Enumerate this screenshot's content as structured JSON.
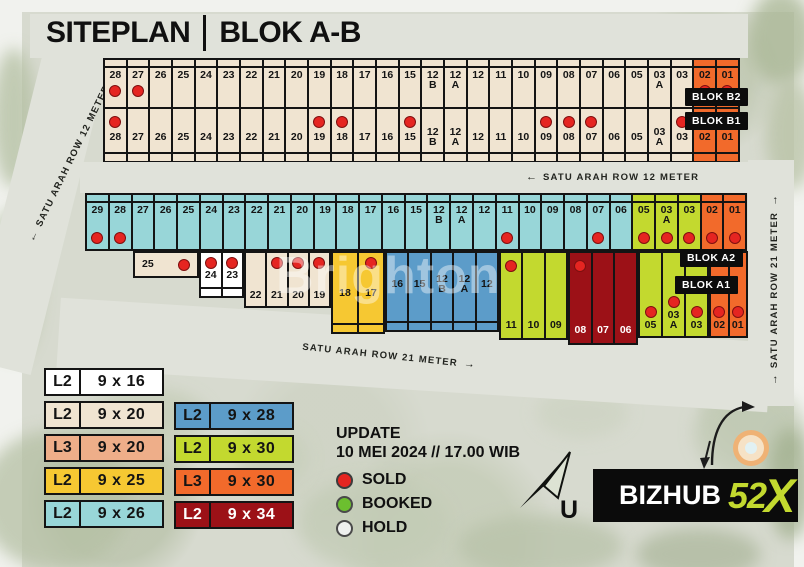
{
  "title": {
    "left": "SITEPLAN",
    "right": "BLOK A-B"
  },
  "watermark": "Brighton",
  "roads": {
    "left": {
      "arrow": "←",
      "text": "SATU ARAH ROW 12 METER"
    },
    "middle": {
      "arrow": "←",
      "text": "SATU ARAH ROW 12 METER"
    },
    "bottom": {
      "text": "SATU ARAH ROW 21 METER",
      "arrow": "→"
    },
    "right": {
      "arrow_start": "→",
      "text": "SATU ARAH ROW 21 METER",
      "arrow_end": "→"
    }
  },
  "colors": {
    "white": "#ffffff",
    "beige": "#f0e4d1",
    "salmon": "#eeae89",
    "yellow": "#f6c832",
    "cyan": "#98d6d8",
    "blue": "#5c9cc9",
    "green": "#c3d92f",
    "orange": "#f26a2b",
    "darkred": "#9c1117",
    "dot_sold": "#e52521",
    "booked": "#6cbf2f",
    "hold": "#eef0ee"
  },
  "blocks": {
    "b2": {
      "label": "BLOK B2",
      "color": "beige",
      "cells": [
        {
          "n": "28",
          "d": 1
        },
        {
          "n": "27",
          "d": 1
        },
        {
          "n": "26"
        },
        {
          "n": "25"
        },
        {
          "n": "24"
        },
        {
          "n": "23"
        },
        {
          "n": "22"
        },
        {
          "n": "21"
        },
        {
          "n": "20"
        },
        {
          "n": "19"
        },
        {
          "n": "18"
        },
        {
          "n": "17"
        },
        {
          "n": "16"
        },
        {
          "n": "15"
        },
        {
          "n": "12\nB"
        },
        {
          "n": "12\nA"
        },
        {
          "n": "12"
        },
        {
          "n": "11"
        },
        {
          "n": "10"
        },
        {
          "n": "09"
        },
        {
          "n": "08"
        },
        {
          "n": "07"
        },
        {
          "n": "06"
        },
        {
          "n": "05"
        },
        {
          "n": "03\nA"
        },
        {
          "n": "03"
        },
        {
          "n": "02",
          "c": "orange",
          "d": 1
        },
        {
          "n": "01",
          "c": "orange",
          "d": 1
        }
      ]
    },
    "b1": {
      "label": "BLOK B1",
      "color": "beige",
      "cells": [
        {
          "n": "28",
          "d": 1
        },
        {
          "n": "27"
        },
        {
          "n": "26"
        },
        {
          "n": "25"
        },
        {
          "n": "24"
        },
        {
          "n": "23"
        },
        {
          "n": "22"
        },
        {
          "n": "21"
        },
        {
          "n": "20"
        },
        {
          "n": "19",
          "d": 1
        },
        {
          "n": "18",
          "d": 1
        },
        {
          "n": "17"
        },
        {
          "n": "16"
        },
        {
          "n": "15",
          "d": 1
        },
        {
          "n": "12\nB"
        },
        {
          "n": "12\nA"
        },
        {
          "n": "12"
        },
        {
          "n": "11"
        },
        {
          "n": "10"
        },
        {
          "n": "09",
          "d": 1
        },
        {
          "n": "08",
          "d": 1
        },
        {
          "n": "07",
          "d": 1
        },
        {
          "n": "06"
        },
        {
          "n": "05"
        },
        {
          "n": "03\nA"
        },
        {
          "n": "03",
          "d": 1
        },
        {
          "n": "02",
          "c": "orange",
          "d": 1
        },
        {
          "n": "01",
          "c": "orange",
          "d": 1
        }
      ]
    },
    "a2": {
      "label": "BLOK A2",
      "color": "cyan",
      "cells": [
        {
          "n": "29",
          "d": 1
        },
        {
          "n": "28",
          "d": 1
        },
        {
          "n": "27"
        },
        {
          "n": "26"
        },
        {
          "n": "25"
        },
        {
          "n": "24"
        },
        {
          "n": "23"
        },
        {
          "n": "22"
        },
        {
          "n": "21"
        },
        {
          "n": "20"
        },
        {
          "n": "19"
        },
        {
          "n": "18"
        },
        {
          "n": "17"
        },
        {
          "n": "16"
        },
        {
          "n": "15"
        },
        {
          "n": "12\nB"
        },
        {
          "n": "12\nA"
        },
        {
          "n": "12"
        },
        {
          "n": "11",
          "d": 1
        },
        {
          "n": "10"
        },
        {
          "n": "09"
        },
        {
          "n": "08"
        },
        {
          "n": "07",
          "d": 1
        },
        {
          "n": "06"
        },
        {
          "n": "05",
          "c": "green",
          "d": 1
        },
        {
          "n": "03\nA",
          "c": "green",
          "d": 1
        },
        {
          "n": "03",
          "c": "green",
          "d": 1
        },
        {
          "n": "02",
          "c": "orange",
          "d": 1
        },
        {
          "n": "01",
          "c": "orange",
          "d": 1
        }
      ]
    },
    "a1": {
      "label": "BLOK A1",
      "groups": [
        {
          "mode": "wide",
          "color": "beige",
          "cells": [
            {
              "n": "25",
              "d": 1
            }
          ]
        },
        {
          "mode": "white",
          "color": "white",
          "cells": [
            {
              "n": "24",
              "d": 1
            },
            {
              "n": "23",
              "d": 1
            }
          ]
        },
        {
          "mode": "mid",
          "color": "beige",
          "cells": [
            {
              "n": "22"
            },
            {
              "n": "21",
              "d": 1
            },
            {
              "n": "20",
              "d": 1
            },
            {
              "n": "19",
              "d": 1
            }
          ]
        },
        {
          "mode": "tallstrip",
          "color": "yellow",
          "cells": [
            {
              "n": "18"
            },
            {
              "n": "17",
              "d": 1
            }
          ]
        },
        {
          "mode": "numstrip",
          "color": "blue",
          "cells": [
            {
              "n": "16"
            },
            {
              "n": "15"
            },
            {
              "n": "12\nB"
            },
            {
              "n": "12\nA"
            },
            {
              "n": "12"
            }
          ]
        },
        {
          "mode": "topdot",
          "color": "green",
          "cells": [
            {
              "n": "11",
              "d": 1
            },
            {
              "n": "10"
            },
            {
              "n": "09"
            }
          ]
        },
        {
          "mode": "topdot",
          "color": "darkred",
          "light": true,
          "cells": [
            {
              "n": "08",
              "d": 1
            },
            {
              "n": "07"
            },
            {
              "n": "06"
            }
          ]
        },
        {
          "mode": "low",
          "color": "green",
          "cells": [
            {
              "n": "05",
              "d": 1
            },
            {
              "n": "03\nA",
              "d": 1
            },
            {
              "n": "03",
              "d": 1
            }
          ]
        },
        {
          "mode": "low",
          "color": "orange",
          "cells": [
            {
              "n": "02",
              "d": 1
            },
            {
              "n": "01",
              "d": 1
            }
          ]
        }
      ]
    }
  },
  "size_legend": {
    "col1": [
      {
        "type": "L2",
        "size": "9 x 16",
        "color": "white"
      },
      {
        "type": "L2",
        "size": "9 x 20",
        "color": "beige"
      },
      {
        "type": "L3",
        "size": "9 x 20",
        "color": "salmon"
      },
      {
        "type": "L2",
        "size": "9 x 25",
        "color": "yellow"
      },
      {
        "type": "L2",
        "size": "9 x 26",
        "color": "cyan"
      }
    ],
    "col2": [
      {
        "type": "L2",
        "size": "9 x 28",
        "color": "blue"
      },
      {
        "type": "L2",
        "size": "9 x 30",
        "color": "green"
      },
      {
        "type": "L3",
        "size": "9 x 30",
        "color": "orange"
      },
      {
        "type": "L2",
        "size": "9 x 34",
        "color": "darkred"
      }
    ]
  },
  "status": {
    "update_label": "UPDATE",
    "update_value": "10 MEI 2024 // 17.00 WIB",
    "items": [
      {
        "label": "SOLD",
        "key": "sold"
      },
      {
        "label": "BOOKED",
        "key": "booked"
      },
      {
        "label": "HOLD",
        "key": "hold"
      }
    ]
  },
  "compass": {
    "label": "U"
  },
  "logo": {
    "brand": "BIZHUB",
    "number": "52",
    "x": "X"
  }
}
